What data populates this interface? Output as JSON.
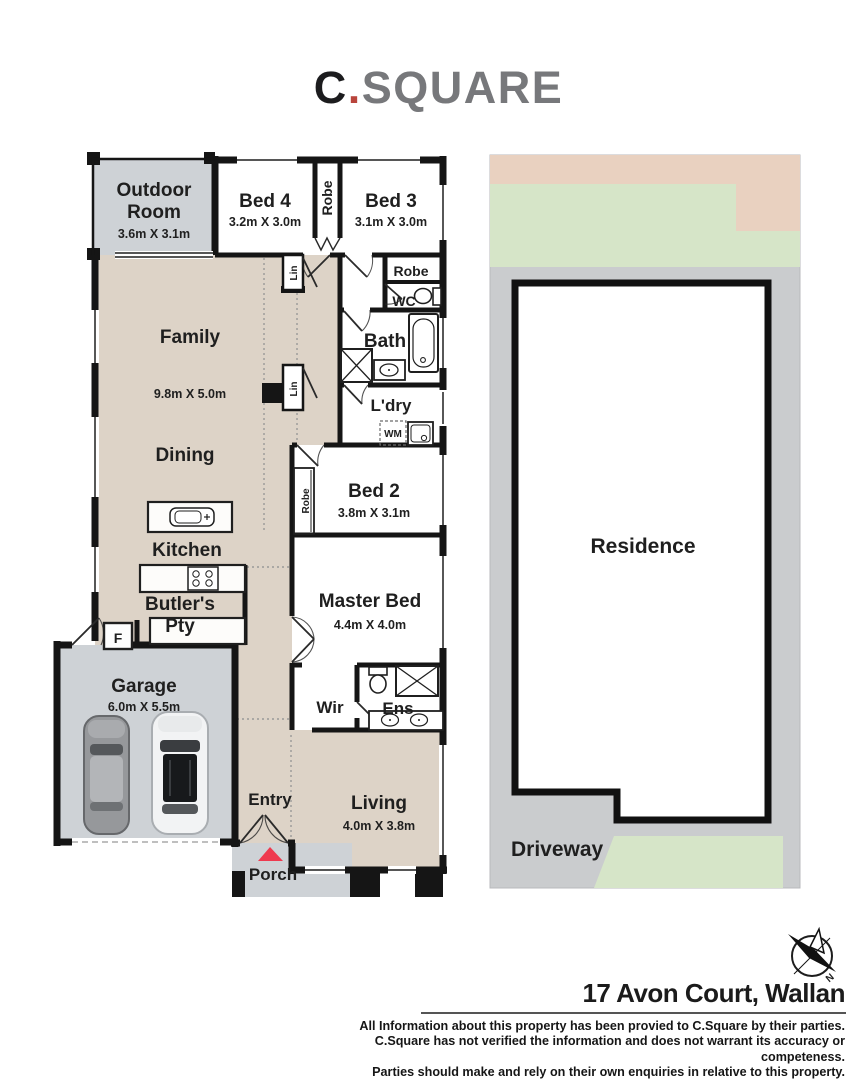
{
  "logo": {
    "part_c": "C",
    "part_dot": ".",
    "part_square": "SQUARE",
    "color_c": "#1c1c1e",
    "color_dot": "#b9453c",
    "color_square": "#77787b"
  },
  "floorplan": {
    "rooms": {
      "outdoor": {
        "name_line1": "Outdoor",
        "name_line2": "Room",
        "dims": "3.6m X 3.1m"
      },
      "bed4": {
        "name": "Bed 4",
        "dims": "3.2m X 3.0m"
      },
      "bed3": {
        "name": "Bed 3",
        "dims": "3.1m X 3.0m"
      },
      "robe_bedrooms": {
        "name": "Robe"
      },
      "robe_hall": {
        "name": "Robe"
      },
      "wc": {
        "name": "WC"
      },
      "bath": {
        "name": "Bath"
      },
      "laundry": {
        "name": "L'dry"
      },
      "wm": {
        "name": "WM"
      },
      "linen_upper": {
        "name": "Lin"
      },
      "linen_lower": {
        "name": "Lin"
      },
      "family": {
        "name": "Family",
        "dims": "9.8m X 5.0m"
      },
      "dining": {
        "name": "Dining"
      },
      "kitchen": {
        "name": "Kitchen"
      },
      "butlers": {
        "name_line1": "Butler's",
        "name_line2": "Pty"
      },
      "fridge": {
        "name": "F"
      },
      "bed2": {
        "name": "Bed 2",
        "dims": "3.8m X 3.1m"
      },
      "robe_bed2": {
        "name": "Robe"
      },
      "master": {
        "name": "Master Bed",
        "dims": "4.4m X 4.0m"
      },
      "garage": {
        "name": "Garage",
        "dims": "6.0m X 5.5m"
      },
      "wir": {
        "name": "Wir"
      },
      "ens": {
        "name": "Ens"
      },
      "entry": {
        "name": "Entry"
      },
      "living": {
        "name": "Living",
        "dims": "4.0m X 3.8m"
      },
      "porch": {
        "name": "Porch"
      }
    },
    "colors": {
      "floor_beige": "#ddd3c7",
      "outdoor_gray": "#ced2d6",
      "wall_black": "#151515",
      "entry_marker_red": "#ee3a4f"
    }
  },
  "siteplan": {
    "labels": {
      "residence": "Residence",
      "driveway": "Driveway"
    },
    "colors": {
      "lot_gray": "#caccce",
      "grass_green": "#d6e5c8",
      "alfresco_tan": "#e9d1c0"
    }
  },
  "compass": {
    "north_label": "N"
  },
  "footer": {
    "address": "17 Avon Court, Wallan",
    "disclaimer_line1": "All Information about this property has been provied to C.Square by their parties.",
    "disclaimer_line2": "C.Square has not verified the information and does not warrant its accuracy or competeness.",
    "disclaimer_line3": "Parties should make and rely on their own enquiries in relative to this property."
  }
}
